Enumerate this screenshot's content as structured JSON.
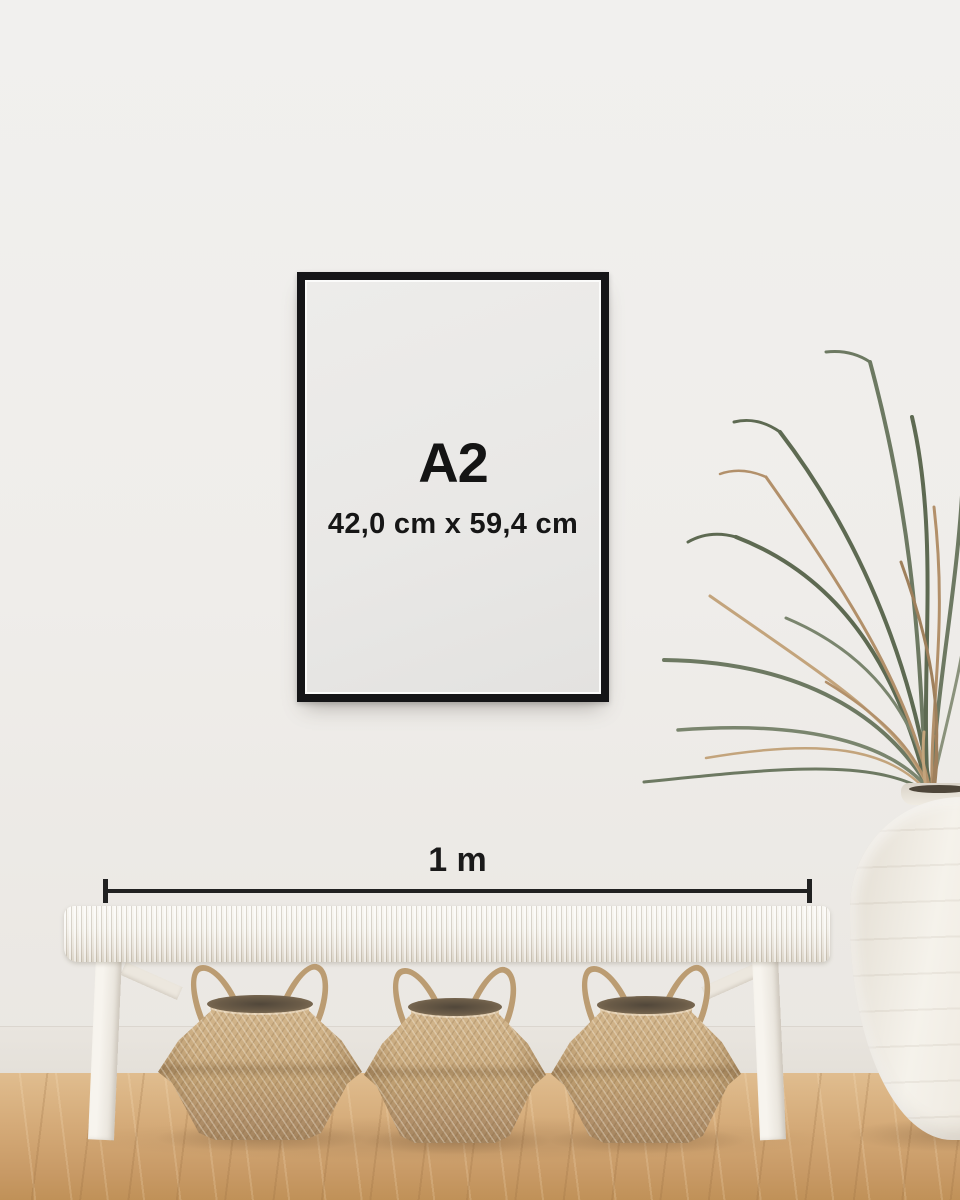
{
  "poster": {
    "size_label": "A2",
    "dimensions_label": "42,0 cm x 59,4 cm",
    "frame_color": "#151517",
    "paper_color": "#e9e8e6",
    "text_color": "#141414"
  },
  "measurement": {
    "label": "1 m",
    "line_color": "#212121"
  },
  "scene": {
    "wall_color": "#efeeec",
    "floor_light": "#e0bd8f",
    "floor_dark": "#c09158",
    "bench_color": "#f3f0e9",
    "basket_color": "#c2a274",
    "vase_color": "#f0ece3",
    "plant_green": "#6d7962",
    "plant_tan": "#b2906a",
    "objects": [
      "framed-poster",
      "size-measurement-line",
      "white-woven-bench",
      "three-seagrass-belly-baskets",
      "dried-palm-plant",
      "white-floor-vase",
      "oak-wood-floor"
    ]
  }
}
